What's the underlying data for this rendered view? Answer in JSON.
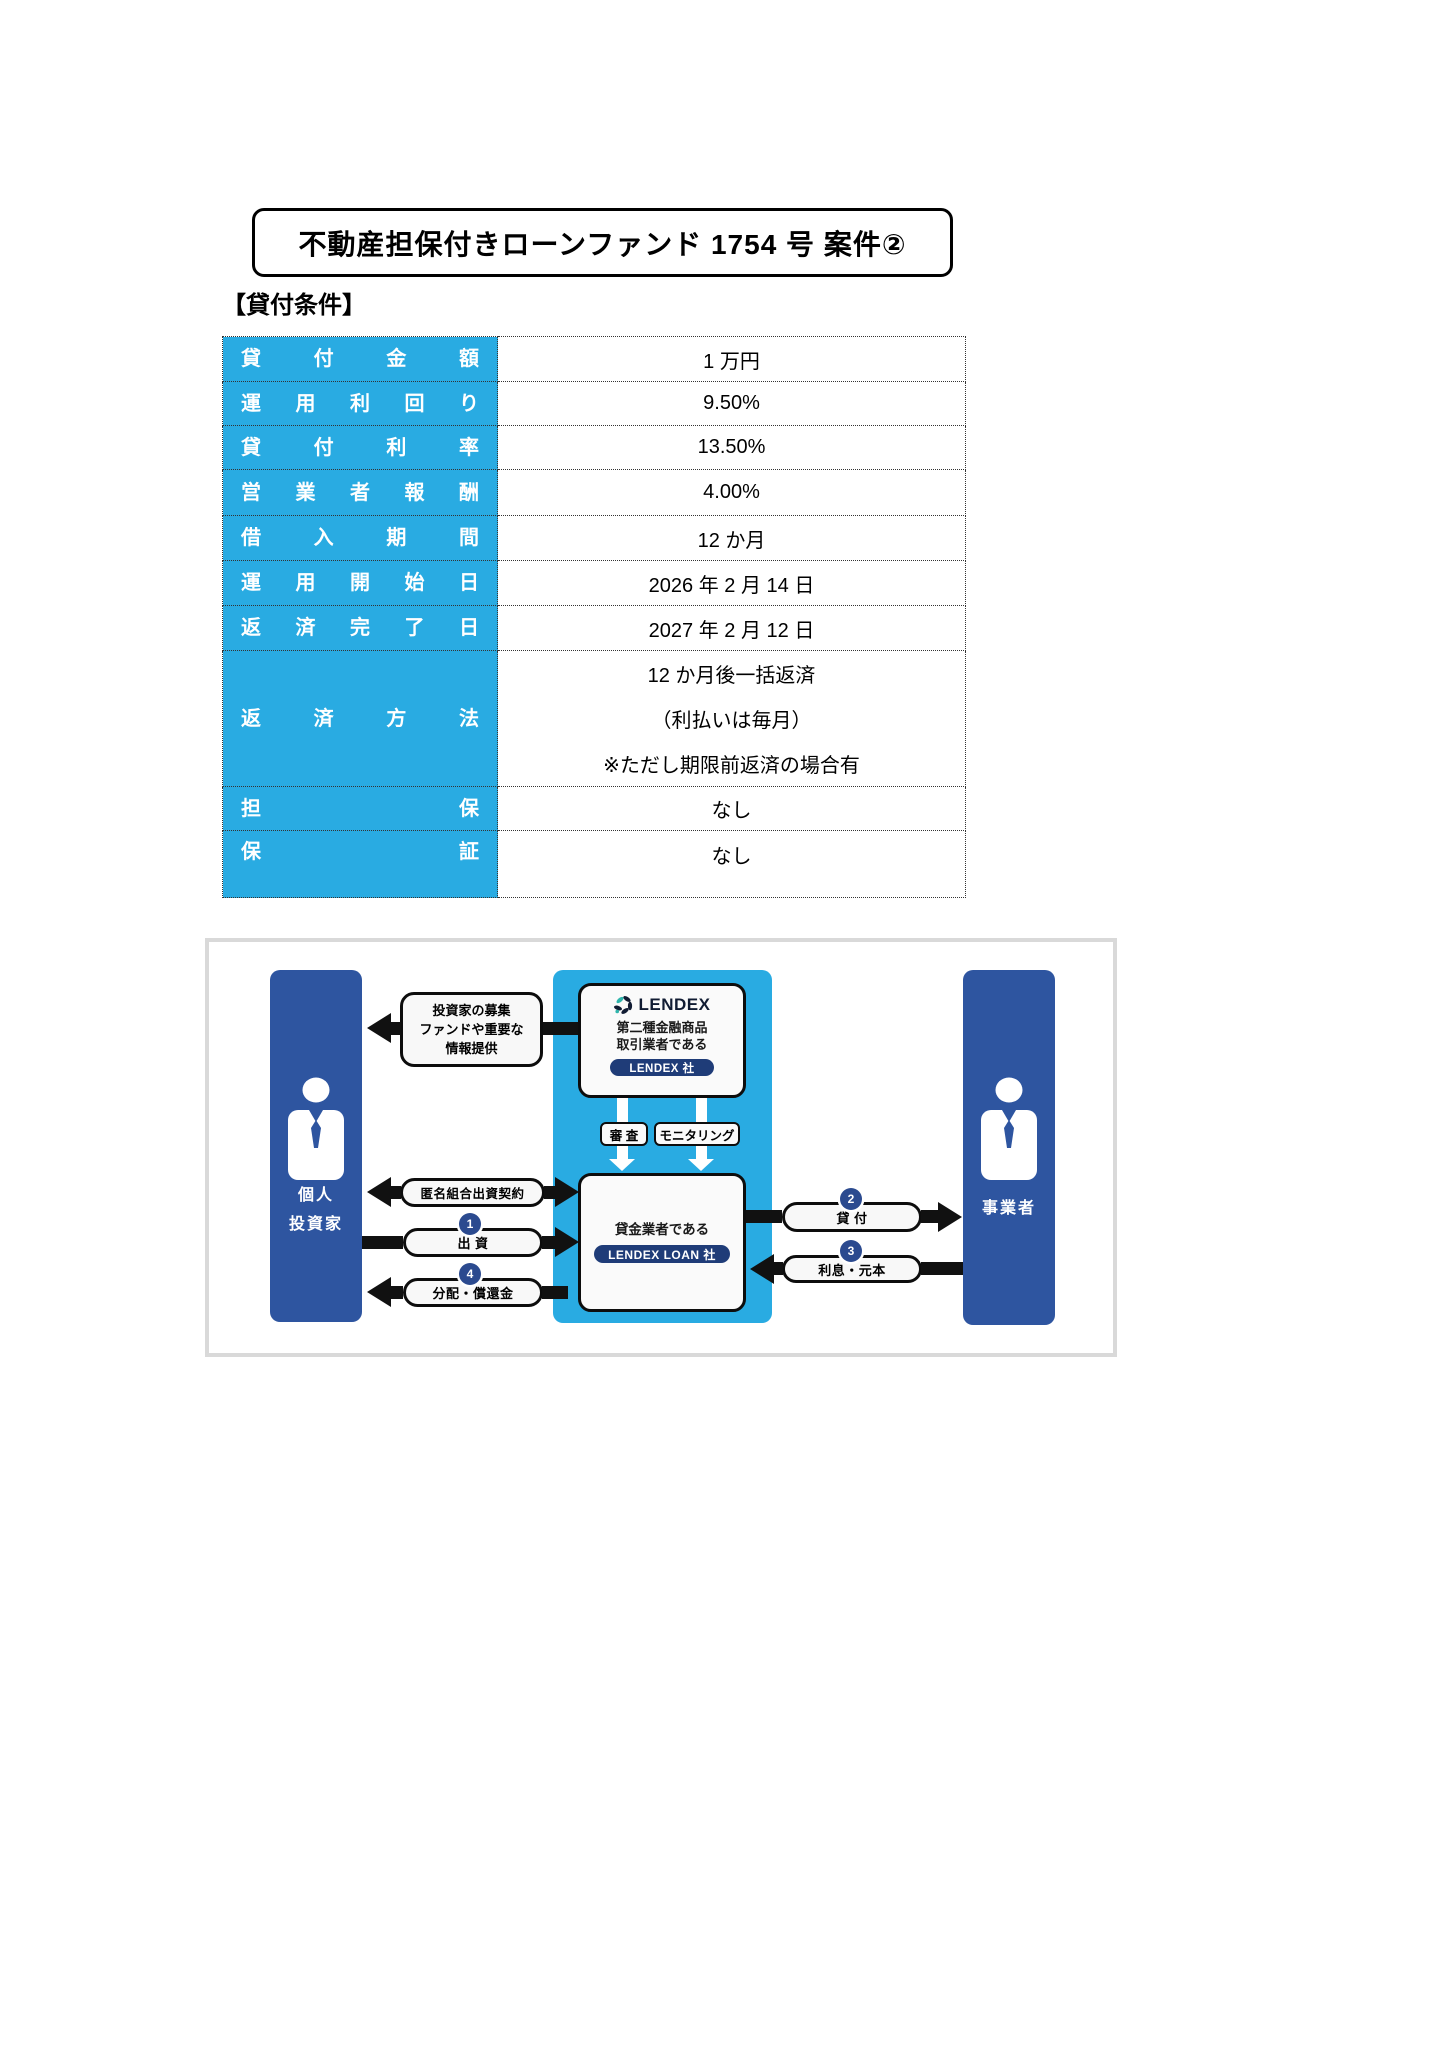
{
  "page": {
    "title_box": "不動産担保付きローンファンド 1754 号 案件②",
    "section_heading": "【貸付条件】"
  },
  "loan_table": {
    "rows": [
      {
        "label": "貸付金額",
        "value": "1 万円"
      },
      {
        "label": "運用利回り",
        "value": "9.50%"
      },
      {
        "label": "貸付利率",
        "value": "13.50%"
      },
      {
        "label": "営業者報酬",
        "value": "4.00%"
      },
      {
        "label": "借入期間",
        "value": "12 か月"
      },
      {
        "label": "運用開始日",
        "value": "2026 年 2 月 14 日"
      },
      {
        "label": "返済完了日",
        "value": "2027 年 2 月 12 日"
      },
      {
        "label": "返済方法",
        "value_lines": [
          "12 か月後一括返済",
          "（利払いは毎月）",
          "※ただし期限前返済の場合有"
        ]
      },
      {
        "label": "担保",
        "value": "なし"
      },
      {
        "label": "保証",
        "value": "なし"
      }
    ]
  },
  "diagram": {
    "investor_label_lines": [
      "個人",
      "投資家"
    ],
    "business_label": "事業者",
    "info_box_lines": [
      "投資家の募集",
      "ファンドや重要な",
      "情報提供"
    ],
    "lendex_box": {
      "logo_text": "LENDEX",
      "desc_lines": [
        "第二種金融商品",
        "取引業者である"
      ],
      "badge": "LENDEX 社"
    },
    "check_label": "審 査",
    "monitoring_label": "モニタリング",
    "loan_box": {
      "desc": "貸金業者である",
      "badge": "LENDEX LOAN 社"
    },
    "flows": {
      "anonymous_partnership": {
        "label": "匿名組合出資契約"
      },
      "investment": {
        "num": "1",
        "label": "出 資"
      },
      "distribution": {
        "num": "4",
        "label": "分配・償還金"
      },
      "lending": {
        "num": "2",
        "label": "貸 付"
      },
      "interest_principal": {
        "num": "3",
        "label": "利息・元本"
      }
    }
  },
  "colors": {
    "bright_blue": "#29ABE2",
    "dark_blue": "#2E55A0",
    "navy": "#1F3C78",
    "badge_circle": "#2B4A8F",
    "logo_dark": "#111C33",
    "logo_teal": "#2FB5AC"
  }
}
